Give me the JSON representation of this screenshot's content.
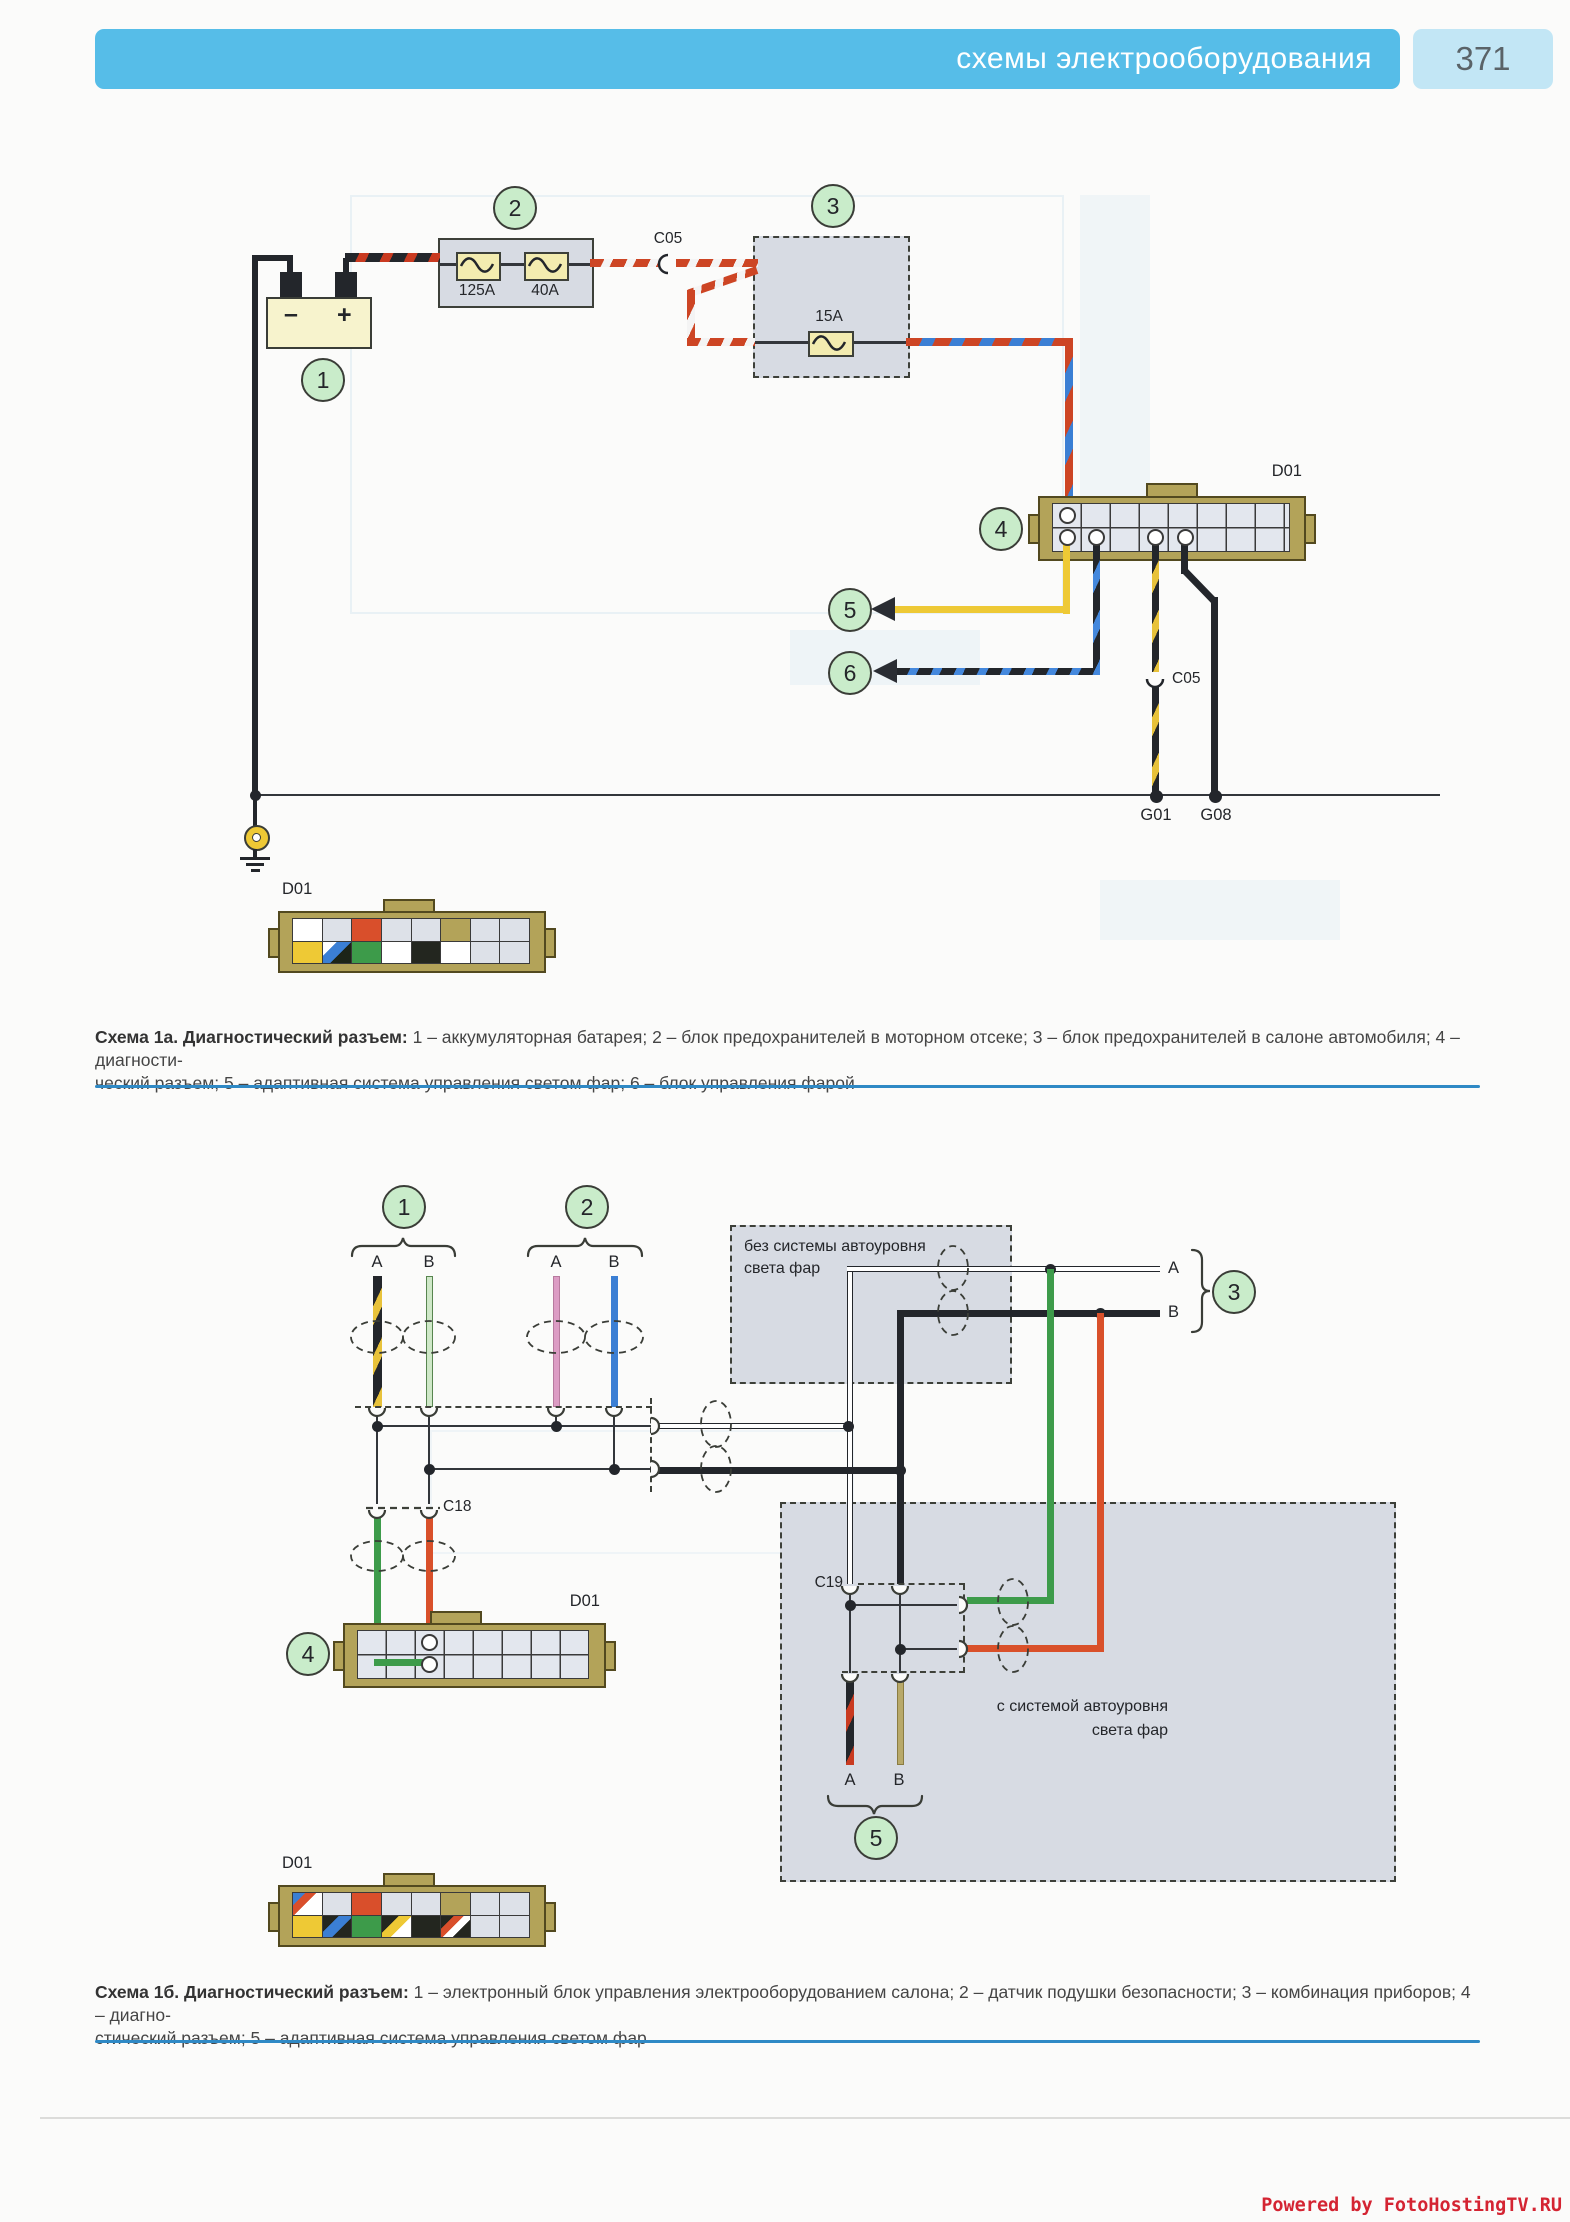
{
  "header": {
    "title": "схемы электрооборудования",
    "page": "371"
  },
  "shared": {
    "pin_a": "A",
    "pin_b": "B"
  },
  "scheme_a": {
    "callout_1": "1",
    "callout_2": "2",
    "callout_3": "3",
    "callout_4": "4",
    "callout_5": "5",
    "callout_6": "6",
    "battery_minus": "–",
    "battery_plus": "+",
    "fuse_125": "125A",
    "fuse_40": "40A",
    "fuse_15": "15A",
    "conn_c05_top": "C05",
    "conn_c05_mid": "C05",
    "conn_d01": "D01",
    "conn_d01_pinout": "D01",
    "ground_g01": "G01",
    "ground_g08": "G08",
    "caption_lead": "Схема 1а. Диагностический разъем:",
    "caption_line1": " 1 – аккумуляторная батарея; 2 – блок предохранителей в моторном отсеке; 3 – блок предохранителей в салоне автомобиля; 4 – диагности-",
    "caption_line2": "ческий разъем; 5 – адаптивная система управления светом фар; 6 – блок управления фарой",
    "pinout_top": [
      "white",
      "gray",
      "red",
      "gray",
      "gray",
      "body",
      "gray",
      "gray"
    ],
    "pinout_bottom": [
      "yellow",
      "diagBlueDark",
      "green",
      "white",
      "black",
      "white",
      "gray",
      "gray"
    ]
  },
  "scheme_b": {
    "callout_1": "1",
    "callout_2": "2",
    "callout_3": "3",
    "callout_4": "4",
    "callout_5": "5",
    "box_without_line1": "без системы автоуровня",
    "box_without_line2": "света фар",
    "box_with_line1": "с системой автоуровня",
    "box_with_line2": "света фар",
    "conn_c18": "C18",
    "conn_c19": "C19",
    "conn_d01": "D01",
    "conn_d01_pinout": "D01",
    "caption_lead": "Схема 1б. Диагностический разъем:",
    "caption_line1": " 1 – электронный блок управления электрооборудованием салона; 2 – датчик подушки безопасности; 3 – комбинация приборов; 4 – диагно-",
    "caption_line2": "стический разъем; 5 – адаптивная система управления светом фар",
    "pinout_top": [
      "diagBlueRed",
      "gray",
      "red",
      "gray",
      "gray",
      "body",
      "gray",
      "gray"
    ],
    "pinout_bottom": [
      "yellow",
      "diagBlueBlack",
      "green",
      "diagYellowBlack",
      "black",
      "diagRedWhiteBlack",
      "gray",
      "gray"
    ]
  },
  "watermark": "Powered by FotoHostingTV.RU",
  "colors": {
    "header_blue": "#56bde8",
    "page_badge_blue": "#c2e6f5",
    "divider_blue": "#2f89c5",
    "callout_green": "#c9ecca",
    "block_gray": "#d7dbe3",
    "connector_tan": "#b3a359",
    "wire_yellow": "#eec935",
    "wire_green": "#3d9b4a",
    "wire_red": "#d9502a",
    "wire_blue": "#3b7fd4",
    "wire_pink": "#dc9cc4",
    "wire_light_green": "#cfe8c8",
    "wire_tan": "#b8a96a",
    "watermark_red": "#d42432"
  }
}
